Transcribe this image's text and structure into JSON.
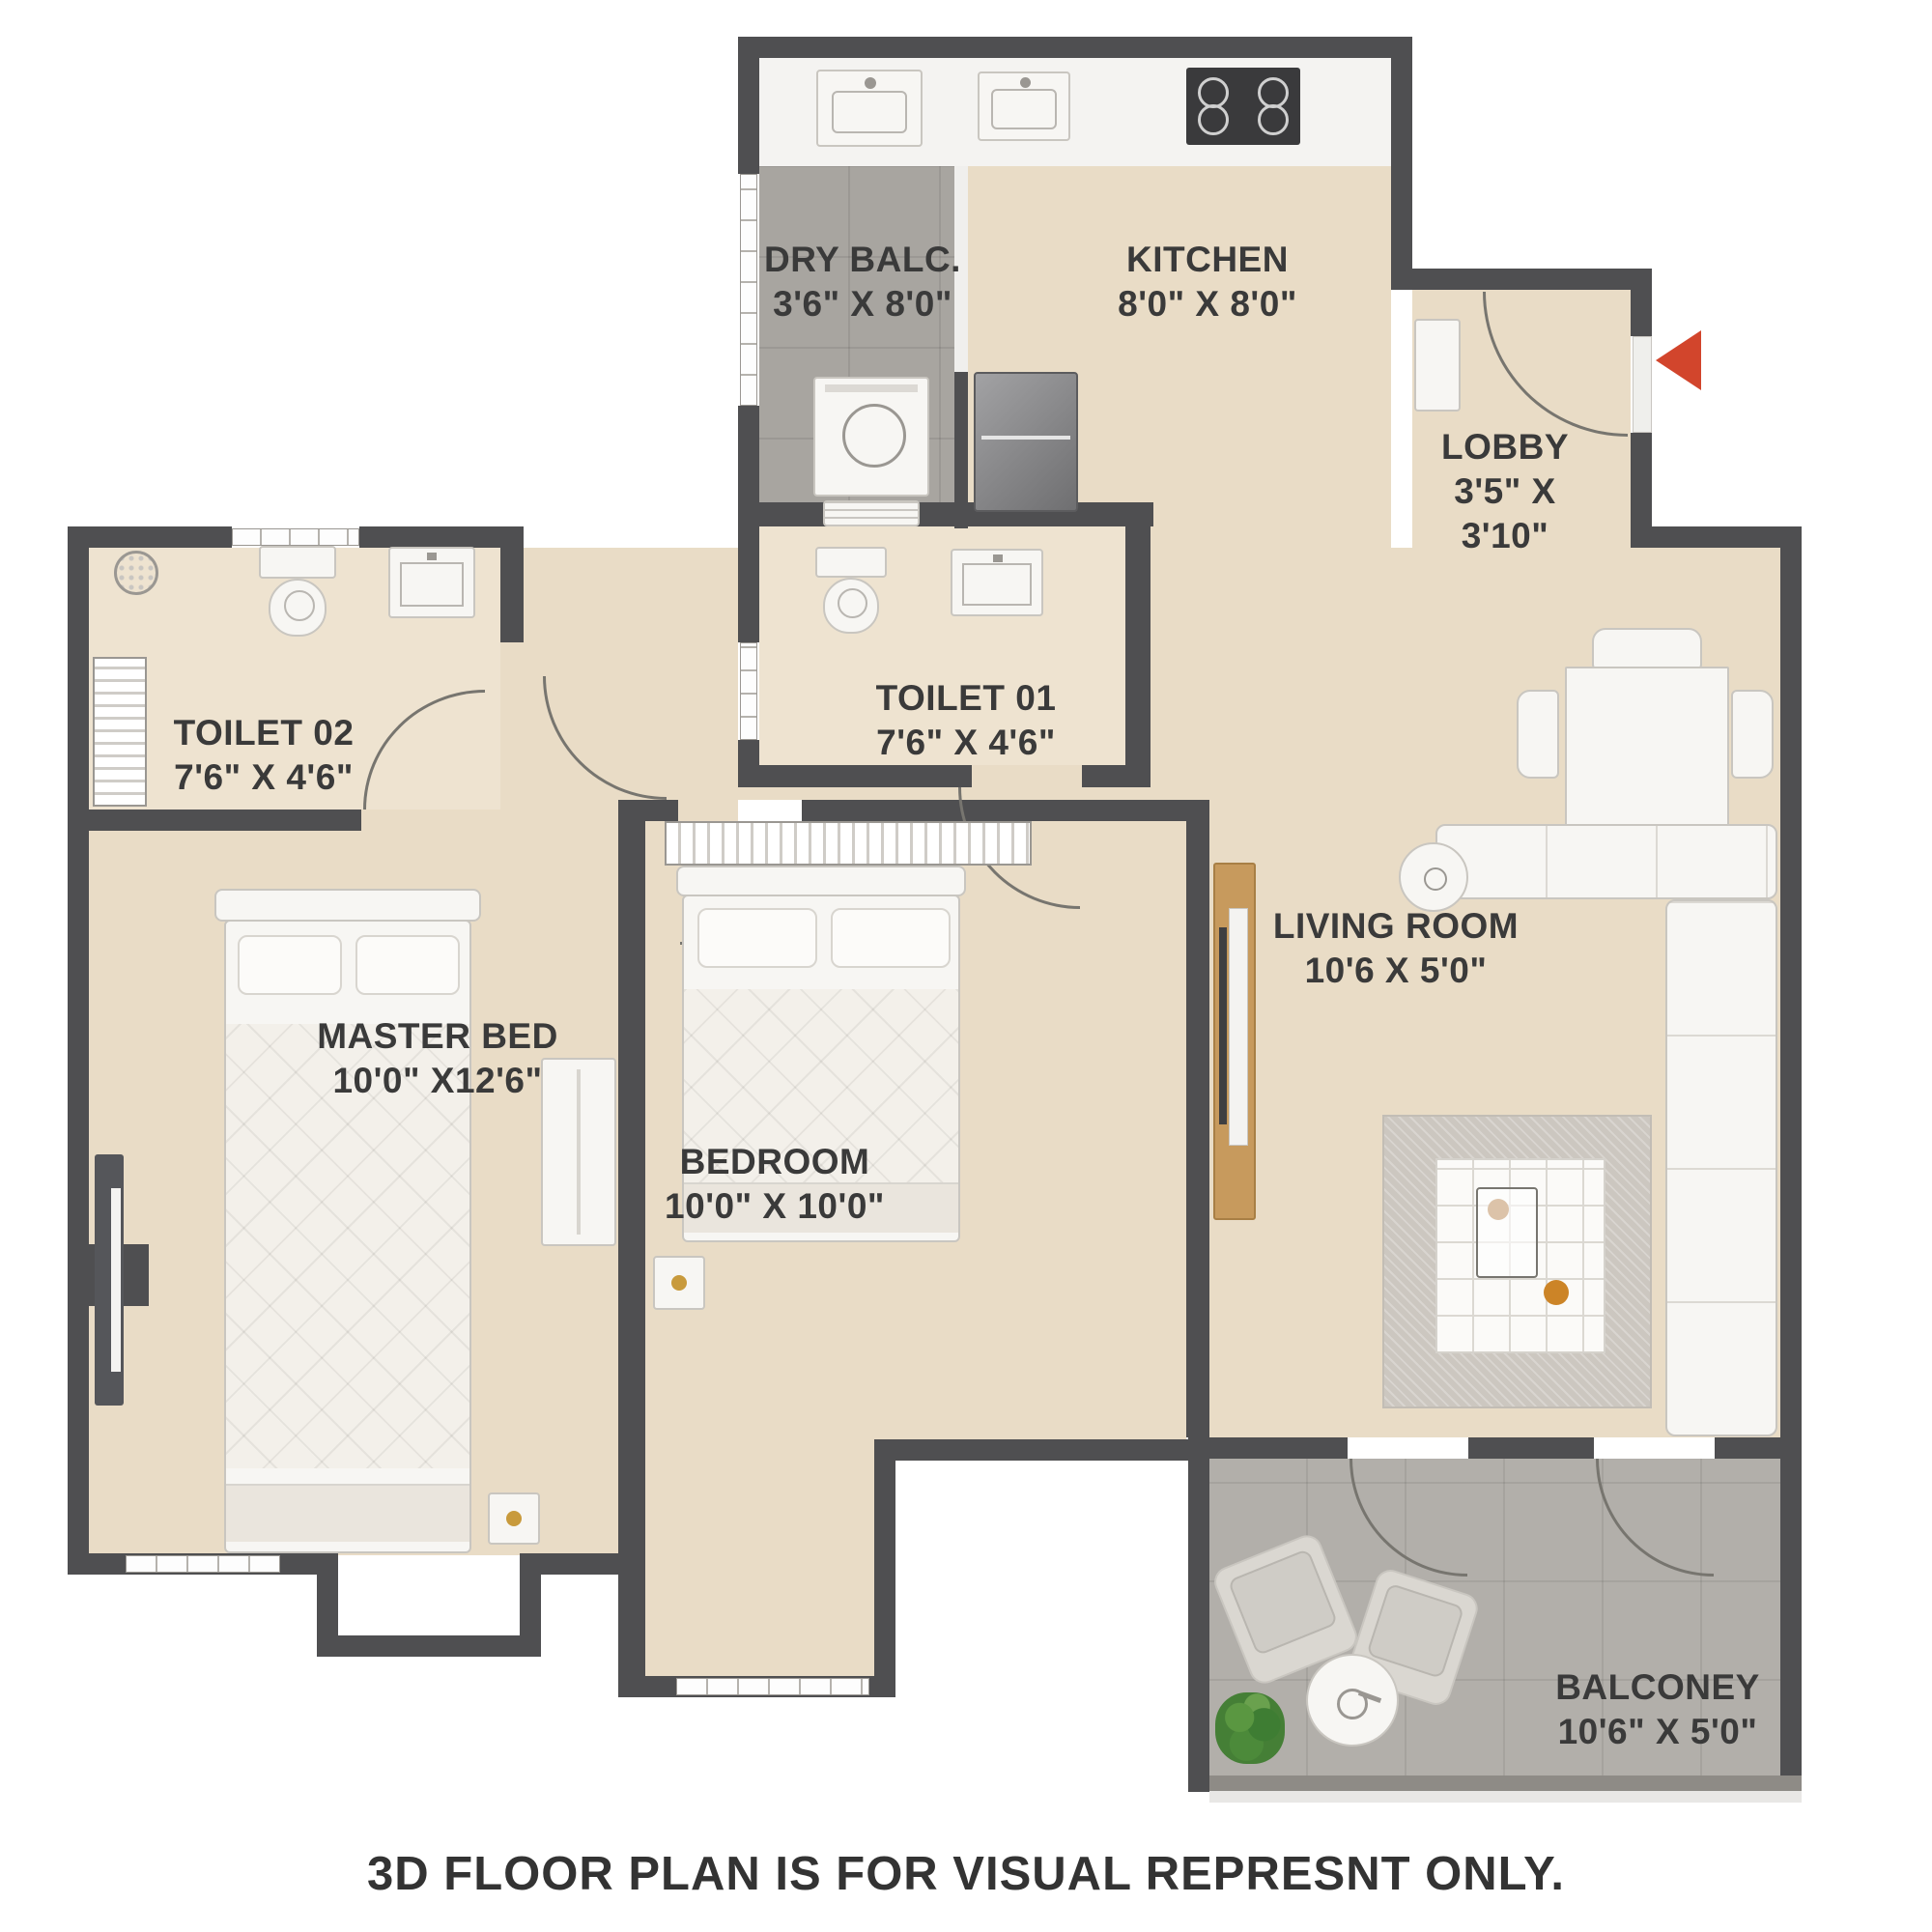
{
  "plan": {
    "rooms": [
      {
        "id": "dry-balcony",
        "label": "DRY BALC.",
        "dims": "3'6\" X 8'0\""
      },
      {
        "id": "kitchen",
        "label": "KITCHEN",
        "dims": "8'0\" X 8'0\""
      },
      {
        "id": "lobby",
        "label": "LOBBY",
        "dims": "3'5\" X 3'10\""
      },
      {
        "id": "toilet-02",
        "label": "TOILET 02",
        "dims": "7'6\" X 4'6\""
      },
      {
        "id": "toilet-01",
        "label": "TOILET 01",
        "dims": "7'6\" X 4'6\""
      },
      {
        "id": "living-room",
        "label": "LIVING ROOM",
        "dims": "10'6 X 5'0\""
      },
      {
        "id": "master-bedroom",
        "label": "MASTER BED",
        "dims": "10'0\" X12'6\""
      },
      {
        "id": "bedroom",
        "label": "BEDROOM",
        "dims": "10'0\" X 10'0\""
      },
      {
        "id": "balcony",
        "label": "BALCONEY",
        "dims": "10'6\" X 5'0\""
      }
    ],
    "disclaimer": "3D FLOOR PLAN IS FOR VISUAL REPRESNT ONLY.",
    "colors": {
      "wall": "#4f4f51",
      "floor_beige": "#e9dcc6",
      "floor_toilet": "#eee3d0",
      "tile_grey": "#a8a5a0",
      "balcony_grey": "#b2afaa",
      "entry_arrow_red": "#d2452c",
      "wood": "#c79a5d",
      "label_text": "#3a3a3a"
    }
  }
}
